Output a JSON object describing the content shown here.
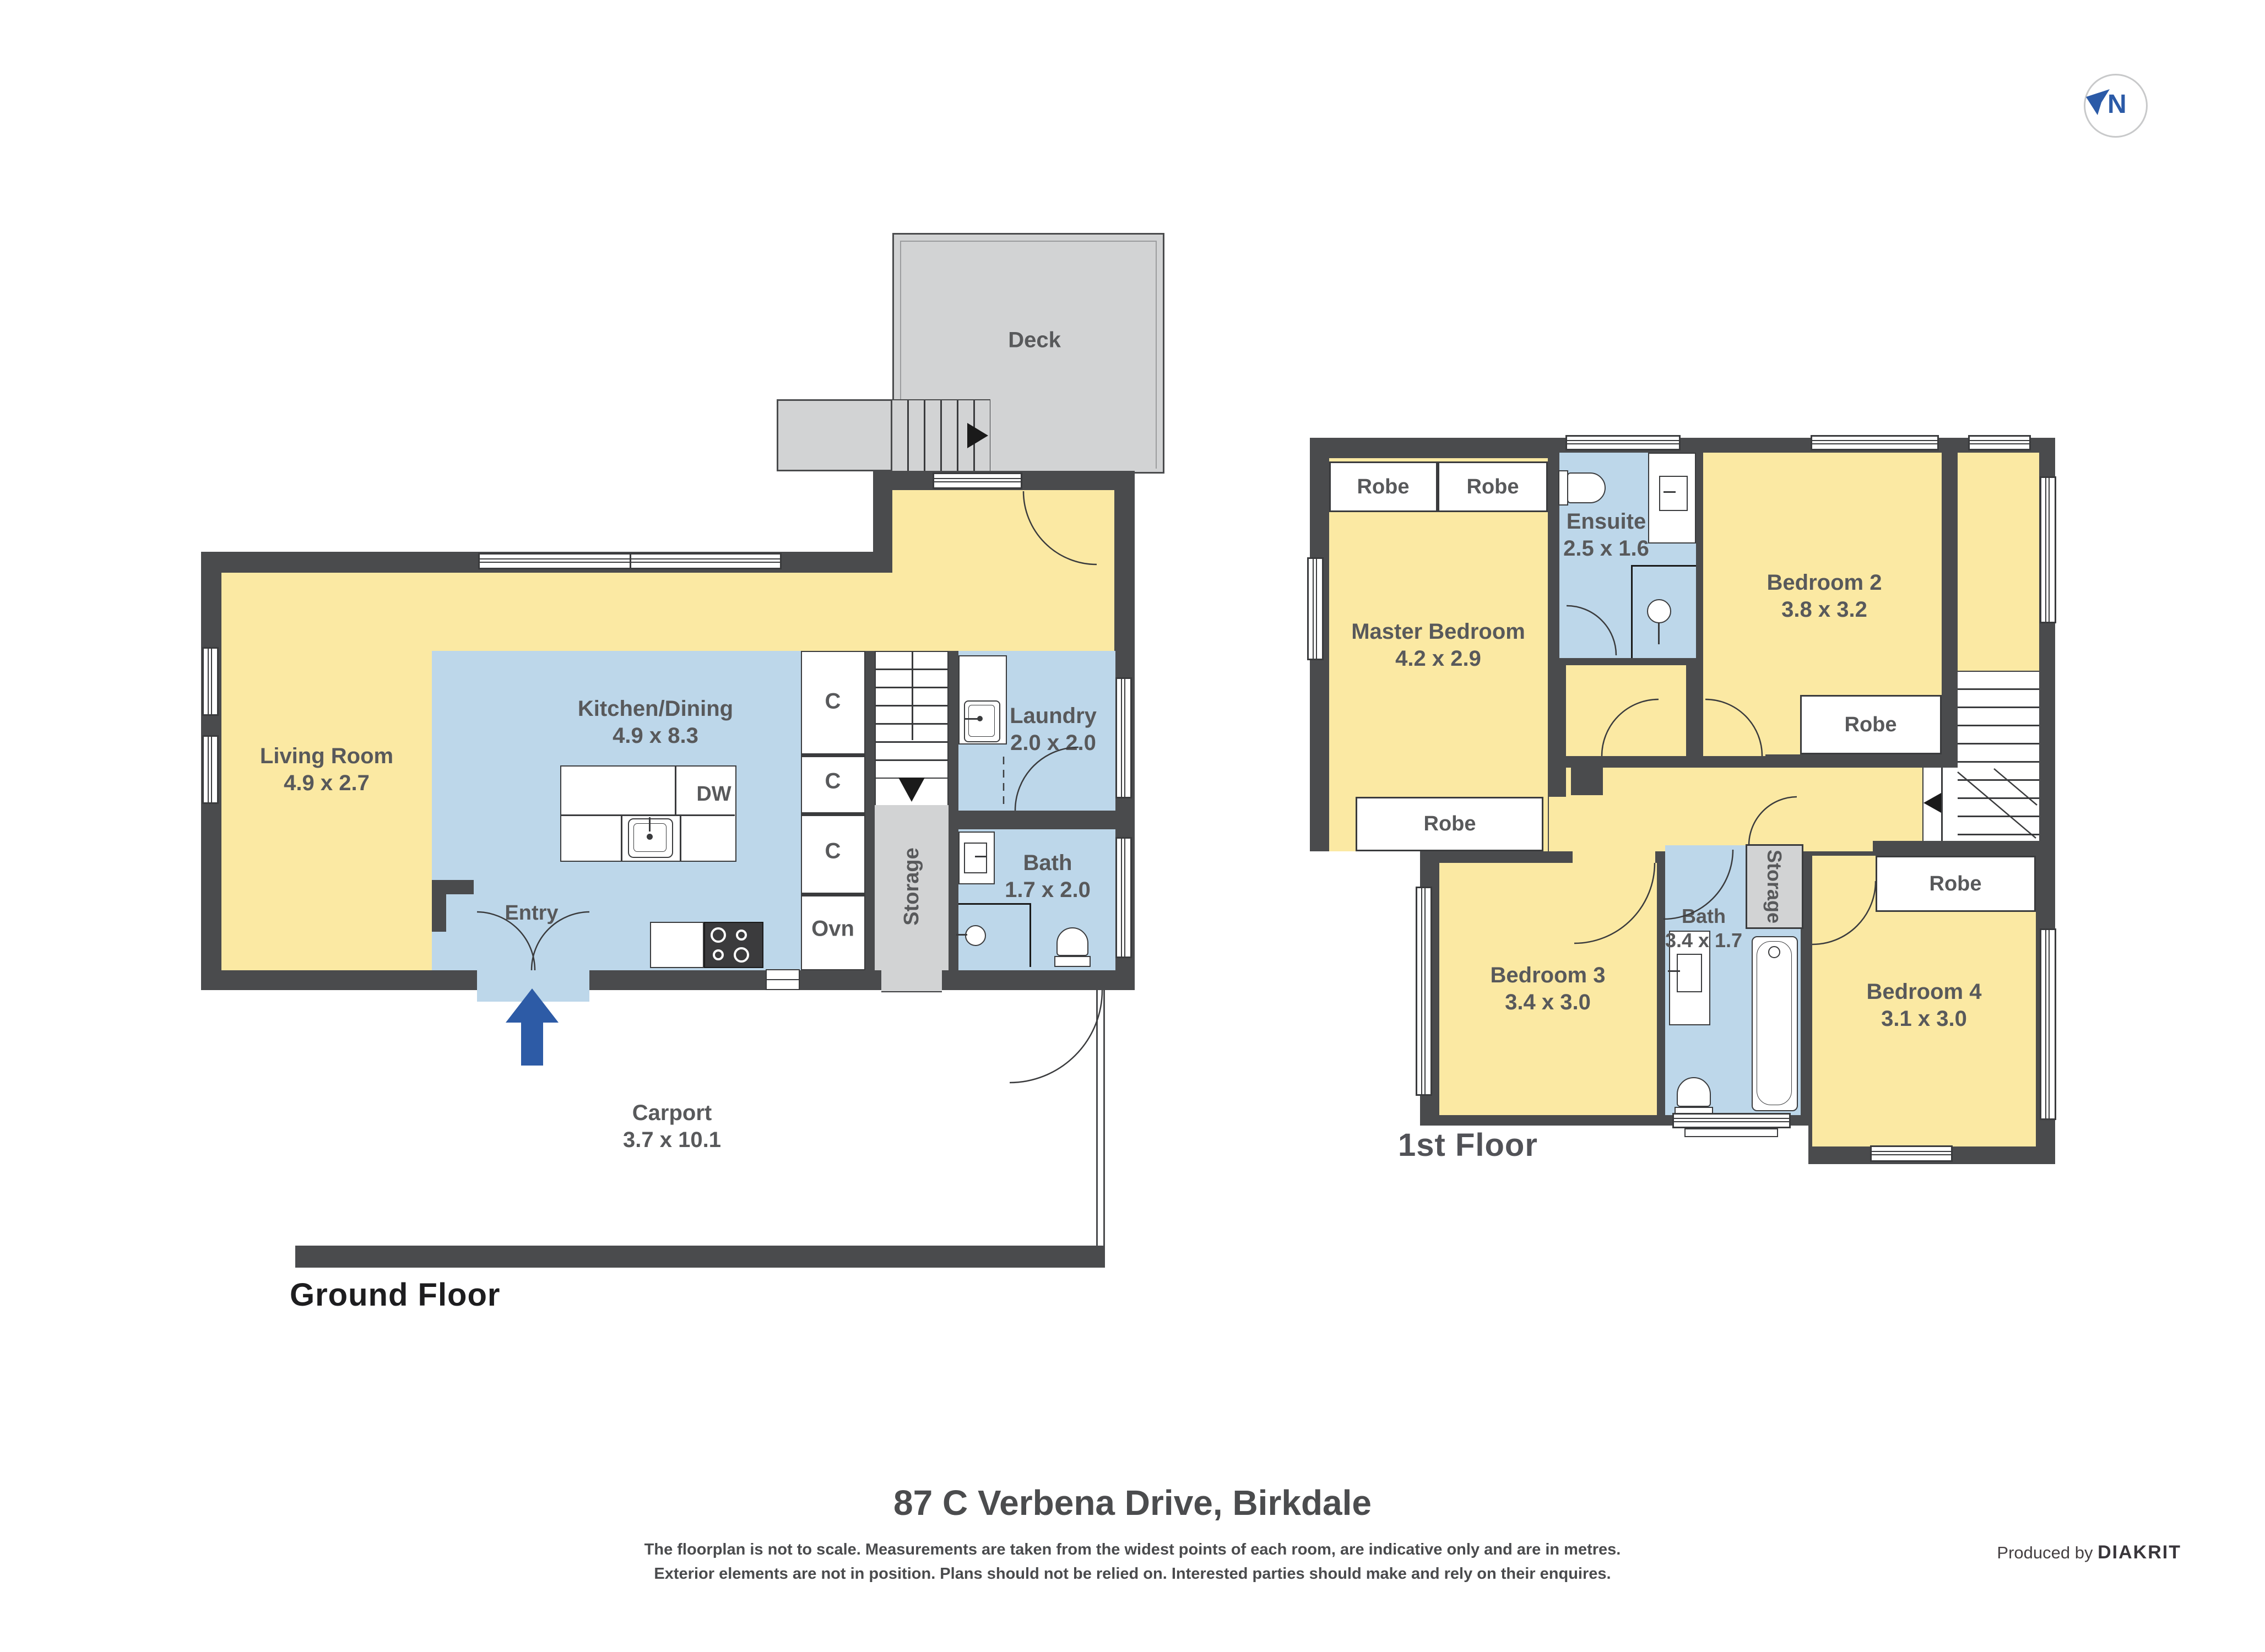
{
  "compass": {
    "letter": "N"
  },
  "ground": {
    "title": "Ground Floor",
    "deck": {
      "name": "Deck"
    },
    "living": {
      "name": "Living Room",
      "dims": "4.9 x 2.7"
    },
    "kitchen": {
      "name": "Kitchen/Dining",
      "dims": "4.9 x 8.3"
    },
    "entry": {
      "name": "Entry"
    },
    "laundry": {
      "name": "Laundry",
      "dims": "2.0 x 2.0"
    },
    "bath": {
      "name": "Bath",
      "dims": "1.7 x 2.0"
    },
    "carport": {
      "name": "Carport",
      "dims": "3.7 x 10.1"
    },
    "storage": {
      "name": "Storage"
    },
    "cupboard1": "C",
    "cupboard2": "C",
    "cupboard3": "C",
    "oven": "Ovn",
    "dishwasher": "DW"
  },
  "first": {
    "title": "1st Floor",
    "master": {
      "name": "Master Bedroom",
      "dims": "4.2 x 2.9"
    },
    "ensuite": {
      "name": "Ensuite",
      "dims": "2.5 x 1.6"
    },
    "bedroom2": {
      "name": "Bedroom 2",
      "dims": "3.8 x 3.2"
    },
    "bedroom3": {
      "name": "Bedroom 3",
      "dims": "3.4 x 3.0"
    },
    "bedroom4": {
      "name": "Bedroom 4",
      "dims": "3.1 x 3.0"
    },
    "bath": {
      "name": "Bath",
      "dims": "3.4 x 1.7"
    },
    "storage": {
      "name": "Storage"
    },
    "robe_master_left": "Robe",
    "robe_master_right": "Robe",
    "robe_master_bottom": "Robe",
    "robe_bedroom2": "Robe",
    "robe_bedroom4": "Robe"
  },
  "footer": {
    "address": "87 C Verbena Drive, Birkdale",
    "disclaimer_line1": "The floorplan is not to scale. Measurements are taken from the widest points of each room, are indicative only and are in metres.",
    "disclaimer_line2": "Exterior elements are not in position. Plans should not be relied on. Interested parties should make and rely on their enquires.",
    "produced_by": "Produced by",
    "brand": "DIAKRIT"
  },
  "colors": {
    "wall": "#4A4B4D",
    "floor_yellow": "#FBE9A3",
    "floor_blue": "#BDD7EA",
    "exterior_gray": "#D2D3D4",
    "label_gray": "#58595B",
    "accent_blue": "#2B5AA7"
  }
}
